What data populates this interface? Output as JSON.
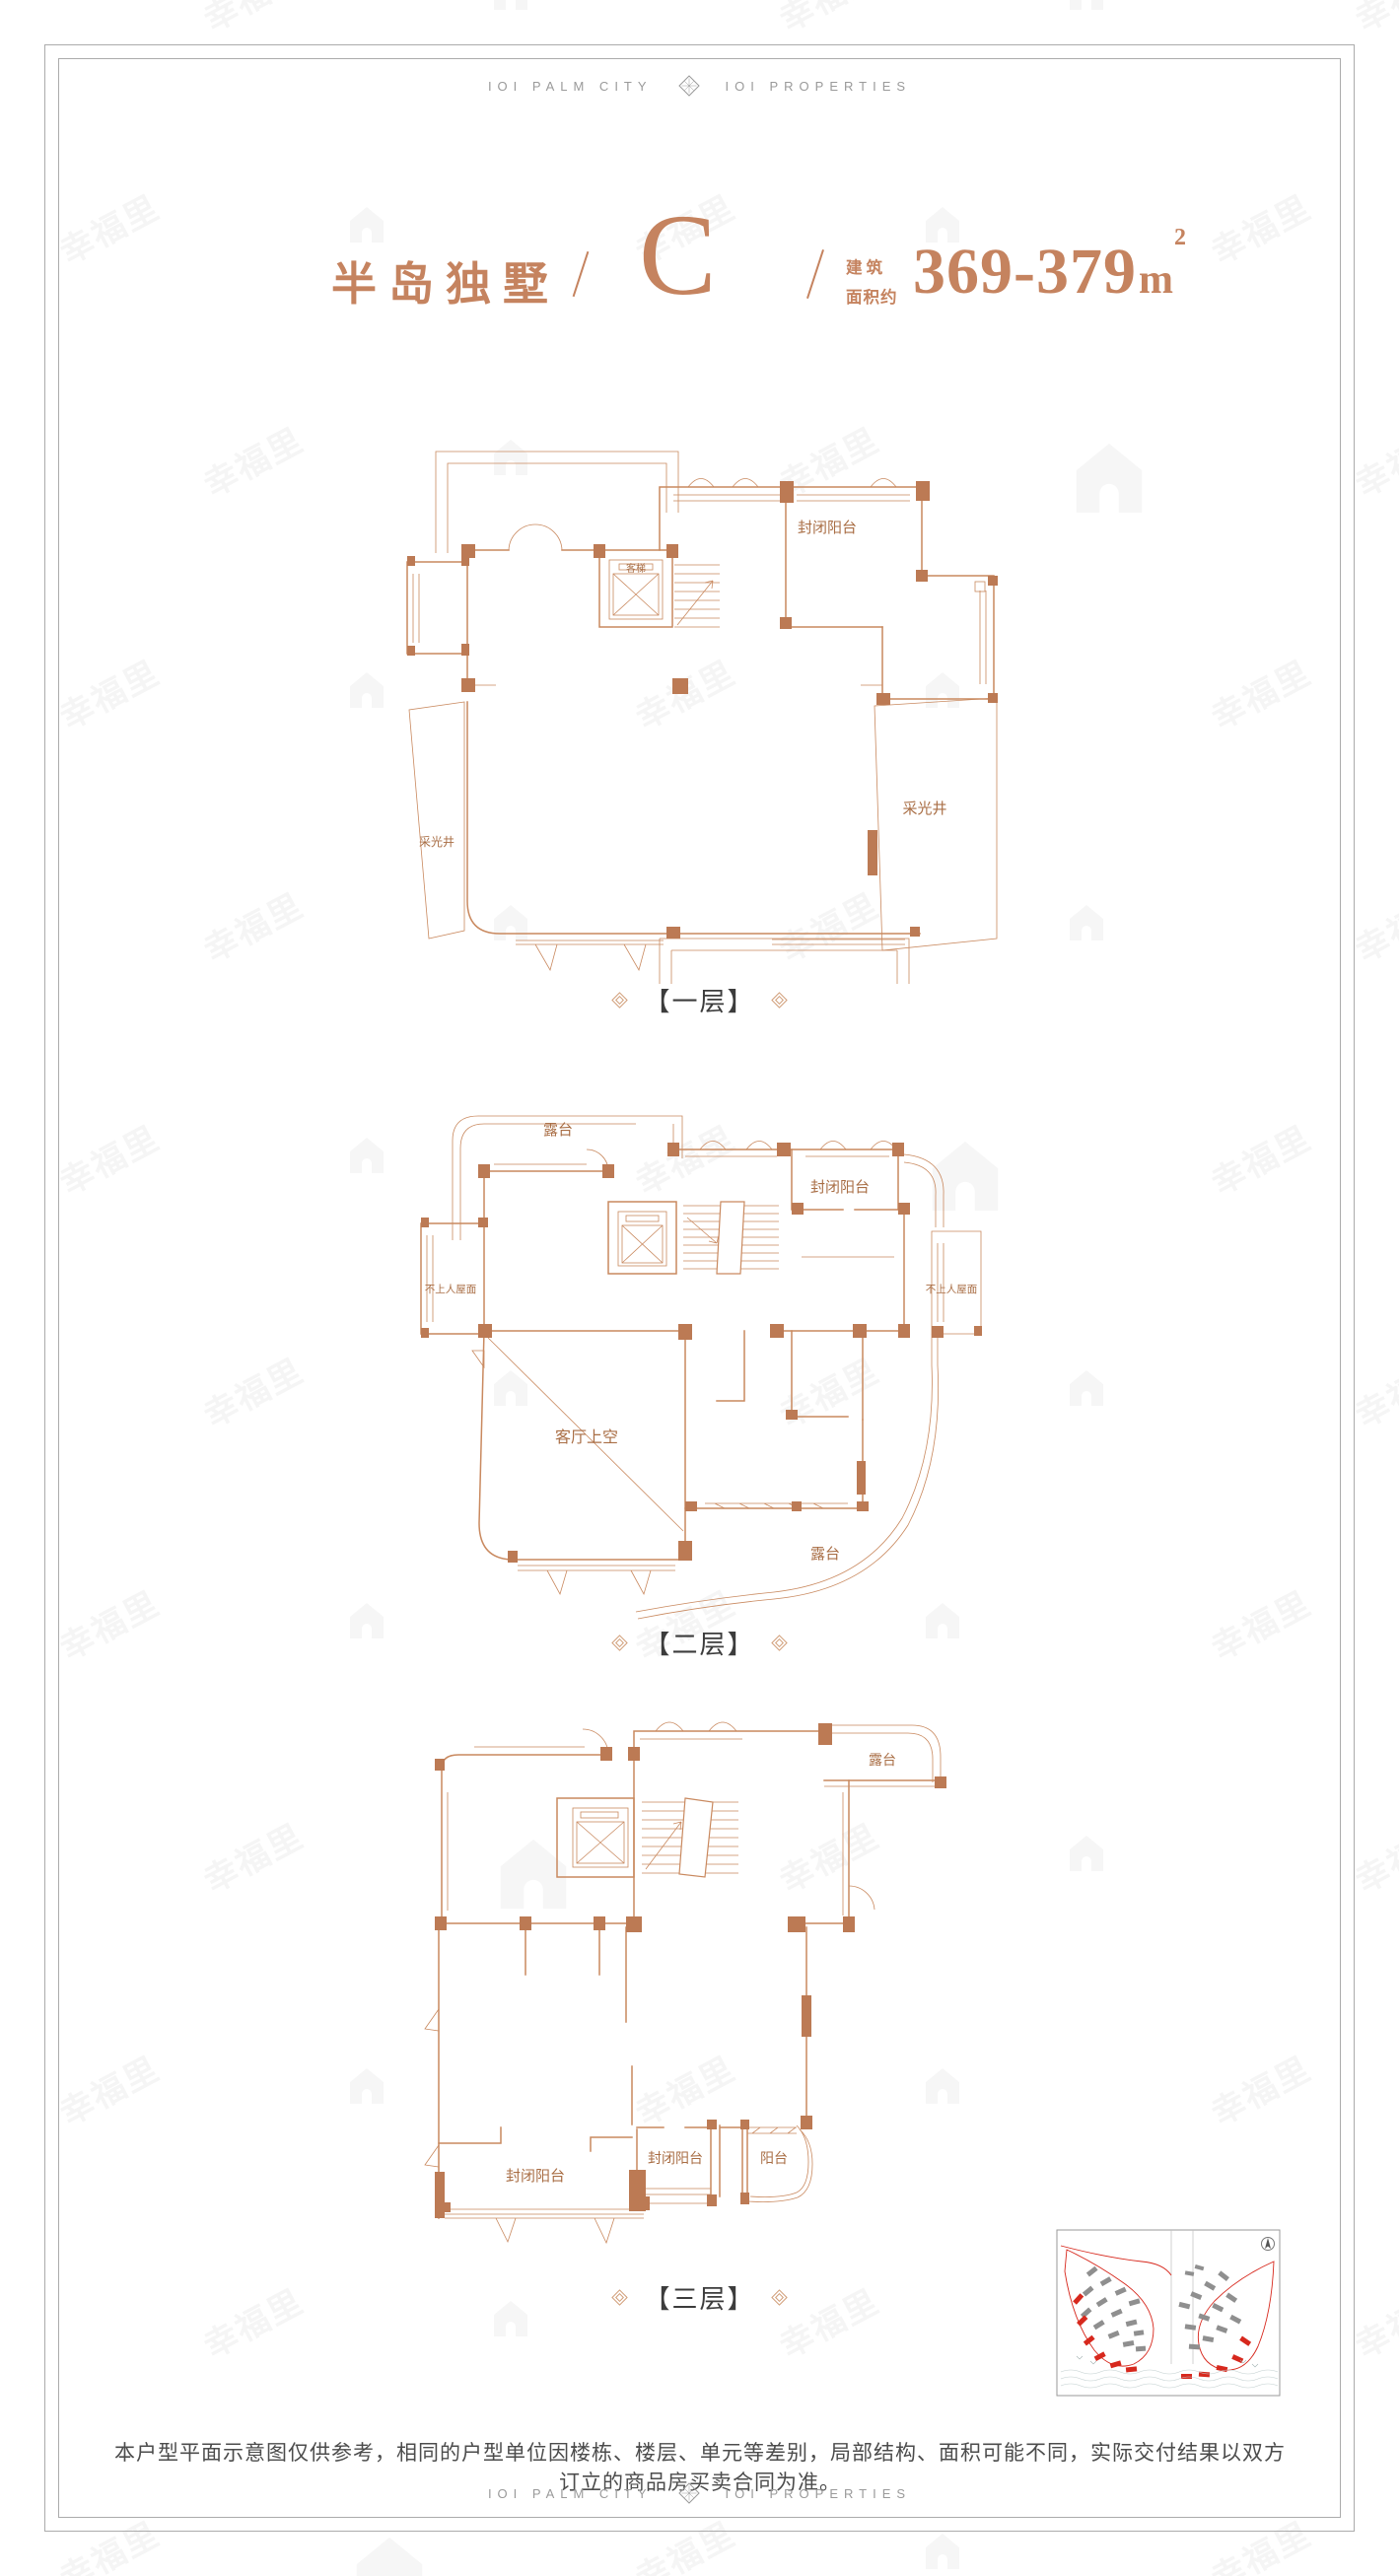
{
  "watermark": {
    "text": "幸福里"
  },
  "brand": {
    "left": "IOI PALM CITY",
    "right": "IOI PROPERTIES"
  },
  "title": {
    "name": "半岛独墅",
    "unit_letter": "C",
    "area_label_line1": "建 筑",
    "area_label_line2": "面积约",
    "area_value": "369-379",
    "area_unit": "m",
    "area_exponent": "2"
  },
  "floors": [
    {
      "caption": "【一层】",
      "labels": {
        "enclosed_balcony": "封闭阳台",
        "elevator": "客梯",
        "lightwell_left": "采光井",
        "lightwell_right": "采光井"
      }
    },
    {
      "caption": "【二层】",
      "labels": {
        "terrace_top": "露台",
        "enclosed_balcony": "封闭阳台",
        "roof_left": "不上人屋面",
        "roof_right": "不上人屋面",
        "living_void": "客厅上空",
        "terrace_bottom": "露台"
      }
    },
    {
      "caption": "【三层】",
      "labels": {
        "terrace_top": "露台",
        "enclosed_balcony_left": "封闭阳台",
        "enclosed_balcony_middle": "封闭阳台",
        "balcony_right": "阳台"
      }
    }
  ],
  "disclaimer": "本户型平面示意图仅供参考，相同的户型单位因楼栋、楼层、单元等差别，局部结构、面积可能不同，实际交付结果以双方订立的商品房买卖合同为准。",
  "colors": {
    "copper": "#c5835f",
    "plan-line": "#c9895f",
    "wall-fill": "#bc7a54",
    "label-brown": "#a96e45",
    "caption-text": "#3c3c3c",
    "brand-gray": "#9a9a9a",
    "map-red": "#d7281d",
    "map-gray": "#8f8f8f",
    "frame-gray": "#ababab",
    "disclaimer-gray": "#4c4c4c"
  }
}
